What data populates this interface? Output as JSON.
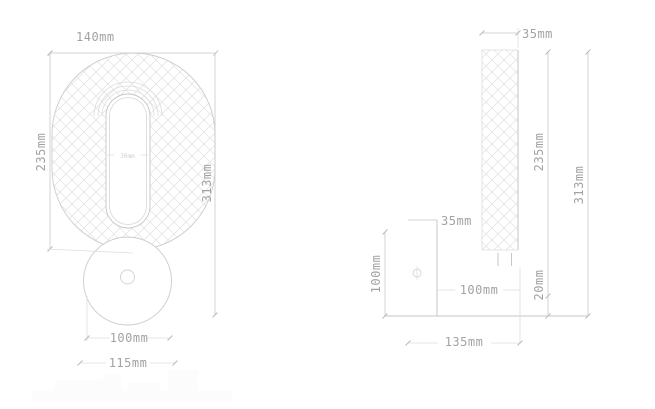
{
  "drawing": {
    "front_view": {
      "width_label": "140mm",
      "shade_height_label": "235mm",
      "overall_height_label": "313mm",
      "slot_width_label": "30mm",
      "canopy_diameter_label": "100mm",
      "canopy_width_label": "115mm"
    },
    "side_view": {
      "shade_thickness_label": "35mm",
      "shade_height_label": "235mm",
      "overall_height_label": "313mm",
      "gap_label": "20mm",
      "plate_thickness_label": "35mm",
      "plate_height_label": "100mm",
      "projection_label": "100mm",
      "total_depth_label": "135mm"
    },
    "colors": {
      "line": "#c6c6c6",
      "hatch": "#e0e0e0",
      "dimension_text": "#a2a2a2"
    }
  }
}
